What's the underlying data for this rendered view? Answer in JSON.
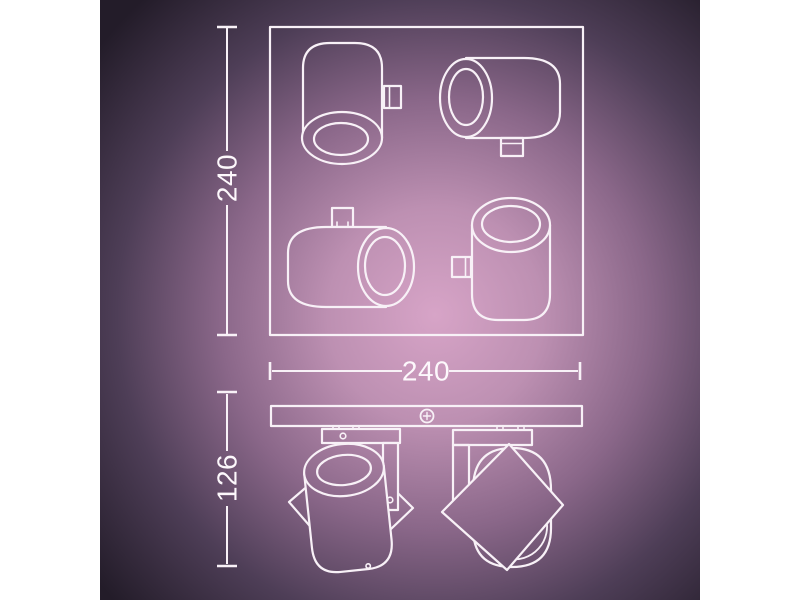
{
  "drawing": {
    "views": {
      "top_view": {
        "height_label": "240",
        "width_label": "240"
      },
      "side_view": {
        "height_label": "126"
      }
    },
    "colors": {
      "line": "#f8f1f7",
      "text": "#fdf8fc",
      "bg_center": "#d7a4c7",
      "bg_mid": "#8a6789",
      "bg_edge": "#231c29",
      "page_margin": "#ffffff"
    }
  }
}
